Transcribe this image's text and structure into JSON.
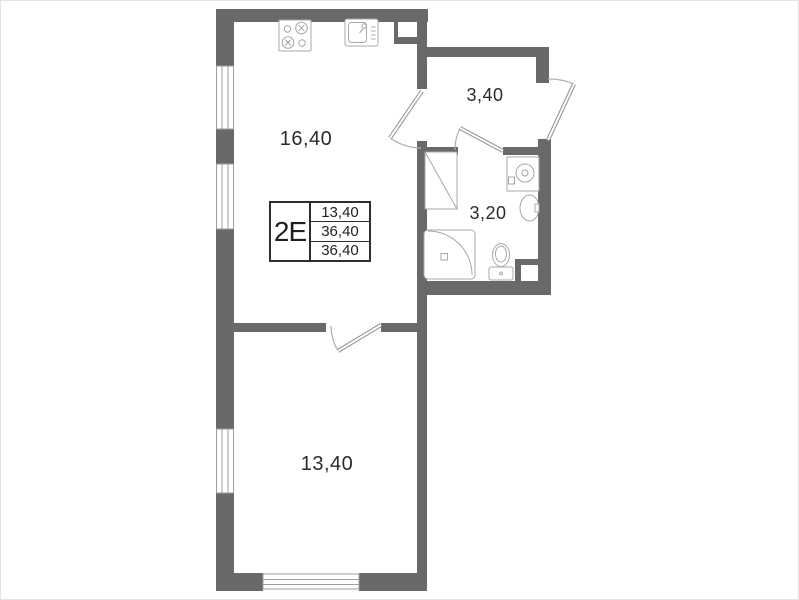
{
  "apartment": {
    "type_label": "2E",
    "stats": [
      "13,40",
      "36,40",
      "36,40"
    ]
  },
  "rooms": {
    "kitchen_living": {
      "area": "16,40"
    },
    "hallway": {
      "area": "3,40"
    },
    "bathroom": {
      "area": "3,20"
    },
    "bedroom": {
      "area": "13,40"
    }
  },
  "icons": [
    "stove-icon",
    "kitchen-sink-icon",
    "shower-icon",
    "toilet-icon",
    "washbasin-icon",
    "washing-machine-icon",
    "vent-shaft-icon",
    "window-icon",
    "door-swing-icon"
  ],
  "colors": {
    "wall": "#696969",
    "thin_line": "#9e9e9e",
    "text": "#2b2b2b",
    "background": "#ffffff"
  }
}
